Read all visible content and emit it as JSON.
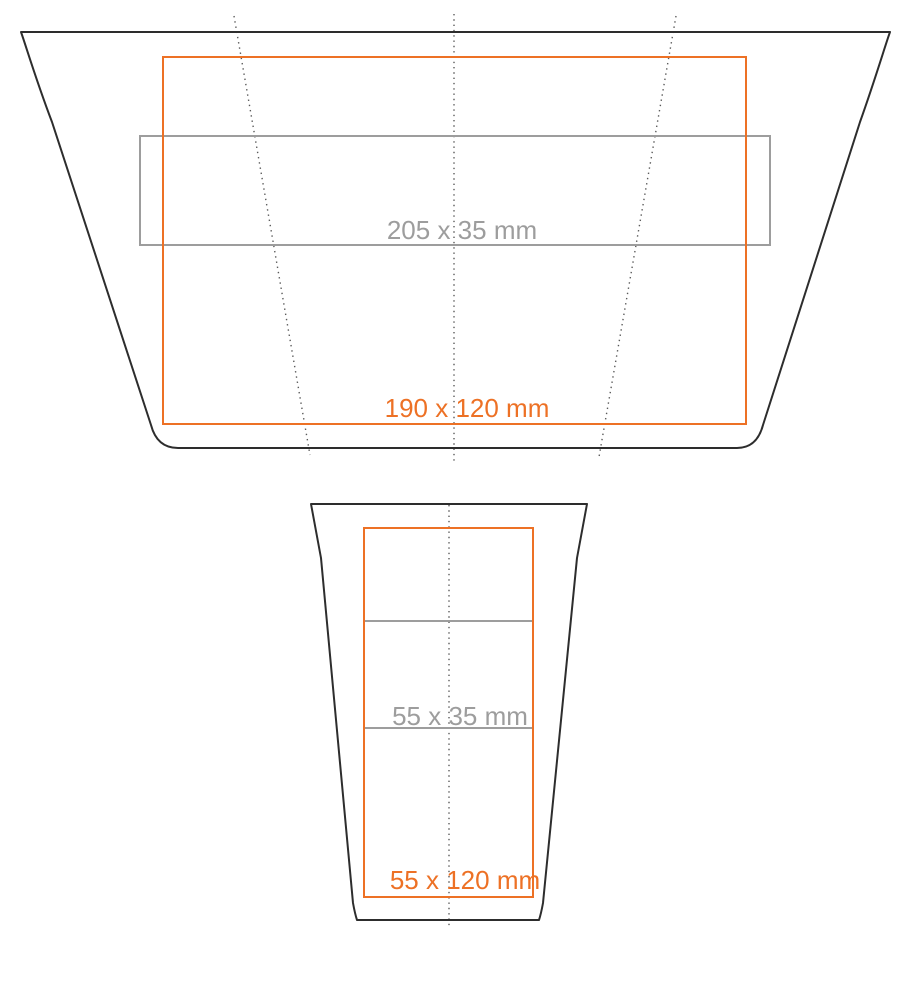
{
  "diagram": {
    "title": "cup print-area template",
    "colors": {
      "outline": "#2d2d2d",
      "accent": "#ed7125",
      "band": "#9d9d9d",
      "fold": "#5a5a5a",
      "bg": "#ffffff"
    },
    "development_view": {
      "description": "unrolled cup wrap (development) outline with fold lines",
      "print_area": {
        "label": "190 x 120 mm",
        "width_mm": 190,
        "height_mm": 120
      },
      "band_area": {
        "label": "205 x 35 mm",
        "width_mm": 205,
        "height_mm": 35
      }
    },
    "front_view": {
      "description": "cup front elevation outline with center line",
      "print_area": {
        "label": "55 x 120 mm",
        "width_mm": 55,
        "height_mm": 120
      },
      "band_area": {
        "label": "55 x 35 mm",
        "width_mm": 55,
        "height_mm": 35
      }
    }
  }
}
